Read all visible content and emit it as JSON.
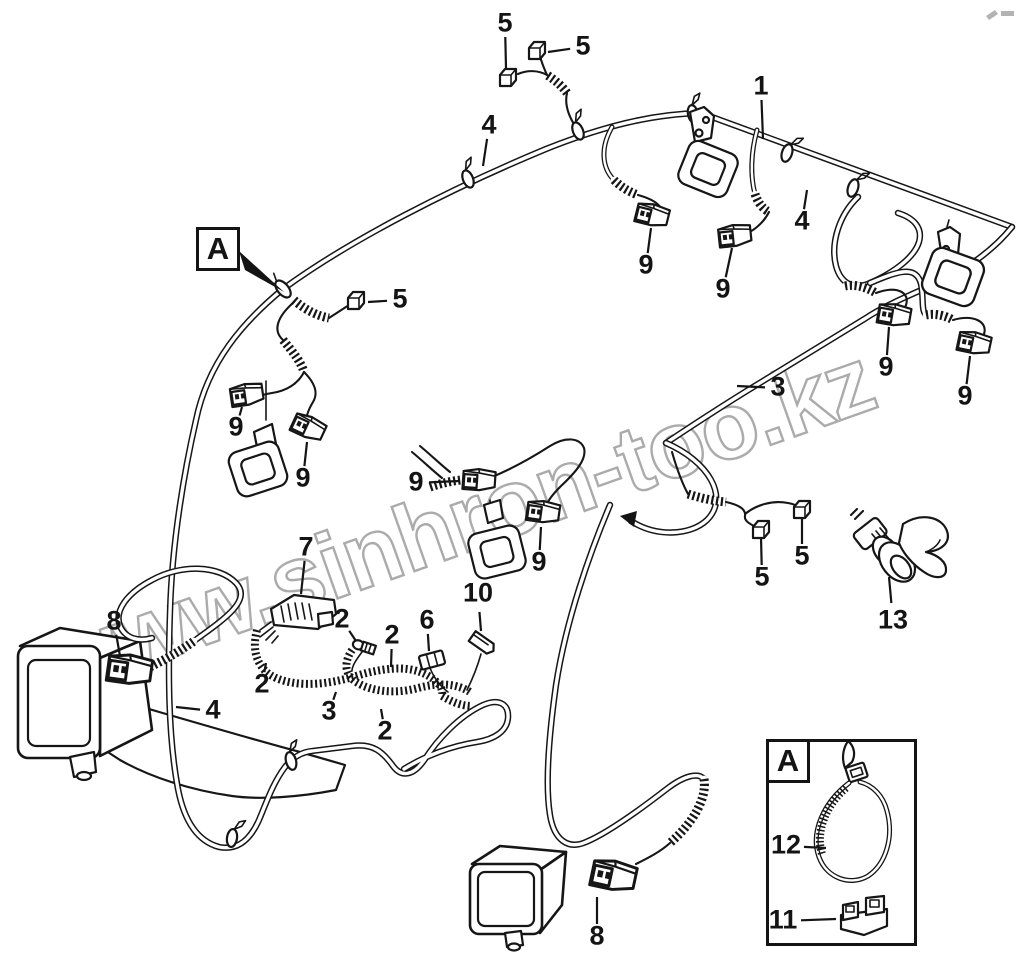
{
  "watermark": {
    "text": "www.sinhron-too.kz"
  },
  "colors": {
    "ink": "#161616",
    "watermark": "#ababab",
    "background": "#ffffff"
  },
  "view_marker": {
    "label": "A",
    "box": {
      "x": 196,
      "y": 227,
      "w": 44,
      "h": 44
    },
    "arrow": [
      [
        239,
        251
      ],
      [
        245,
        270
      ],
      [
        284,
        292
      ]
    ]
  },
  "detail_box": {
    "label": "A",
    "x": 766,
    "y": 739,
    "w": 151,
    "h": 207,
    "label_box": {
      "w": 44,
      "h": 44
    }
  },
  "callouts": [
    {
      "t": "5",
      "x": 505,
      "y": 24,
      "tx": 506,
      "ty": 68
    },
    {
      "t": "5",
      "x": 583,
      "y": 47,
      "tx": 548,
      "ty": 52
    },
    {
      "t": "4",
      "x": 489,
      "y": 126,
      "tx": 483,
      "ty": 166
    },
    {
      "t": "1",
      "x": 761,
      "y": 87,
      "tx": 763,
      "ty": 139
    },
    {
      "t": "4",
      "x": 802,
      "y": 222,
      "tx": 807,
      "ty": 190
    },
    {
      "t": "5",
      "x": 400,
      "y": 300,
      "tx": 368,
      "ty": 302
    },
    {
      "t": "9",
      "x": 236,
      "y": 428,
      "tx": 242,
      "ty": 407
    },
    {
      "t": "9",
      "x": 303,
      "y": 479,
      "tx": 307,
      "ty": 442
    },
    {
      "t": "9",
      "x": 646,
      "y": 266,
      "tx": 651,
      "ty": 228
    },
    {
      "t": "9",
      "x": 723,
      "y": 290,
      "tx": 732,
      "ty": 248
    },
    {
      "t": "3",
      "x": 778,
      "y": 388,
      "tx": 737,
      "ty": 386
    },
    {
      "t": "9",
      "x": 886,
      "y": 368,
      "tx": 889,
      "ty": 327
    },
    {
      "t": "9",
      "x": 965,
      "y": 397,
      "tx": 970,
      "ty": 356
    },
    {
      "t": "9",
      "x": 416,
      "y": 483,
      "tx": 459,
      "ty": 481
    },
    {
      "t": "9",
      "x": 539,
      "y": 563,
      "tx": 541,
      "ty": 527
    },
    {
      "t": "7",
      "x": 306,
      "y": 548,
      "tx": 301,
      "ty": 594
    },
    {
      "t": "5",
      "x": 762,
      "y": 578,
      "tx": 761,
      "ty": 537
    },
    {
      "t": "5",
      "x": 802,
      "y": 557,
      "tx": 802,
      "ty": 517
    },
    {
      "t": "13",
      "x": 893,
      "y": 621,
      "tx": 889,
      "ty": 577
    },
    {
      "t": "8",
      "x": 114,
      "y": 622,
      "tx": 120,
      "ty": 656
    },
    {
      "t": "4",
      "x": 213,
      "y": 711,
      "tx": 176,
      "ty": 707
    },
    {
      "t": "2",
      "x": 262,
      "y": 685,
      "tx": 266,
      "ty": 663
    },
    {
      "t": "2",
      "x": 342,
      "y": 620,
      "tx": 356,
      "ty": 641
    },
    {
      "t": "2",
      "x": 392,
      "y": 636,
      "tx": 391,
      "ty": 667
    },
    {
      "t": "6",
      "x": 427,
      "y": 621,
      "tx": 429,
      "ty": 651
    },
    {
      "t": "10",
      "x": 478,
      "y": 594,
      "tx": 481,
      "ty": 631
    },
    {
      "t": "3",
      "x": 329,
      "y": 712,
      "tx": 336,
      "ty": 692
    },
    {
      "t": "2",
      "x": 385,
      "y": 732,
      "tx": 381,
      "ty": 709
    },
    {
      "t": "8",
      "x": 597,
      "y": 937,
      "tx": 597,
      "ty": 897
    },
    {
      "t": "12",
      "x": 786,
      "y": 846,
      "tx": 826,
      "ty": 848
    },
    {
      "t": "11",
      "x": 783,
      "y": 921,
      "tx": 836,
      "ty": 919
    }
  ]
}
